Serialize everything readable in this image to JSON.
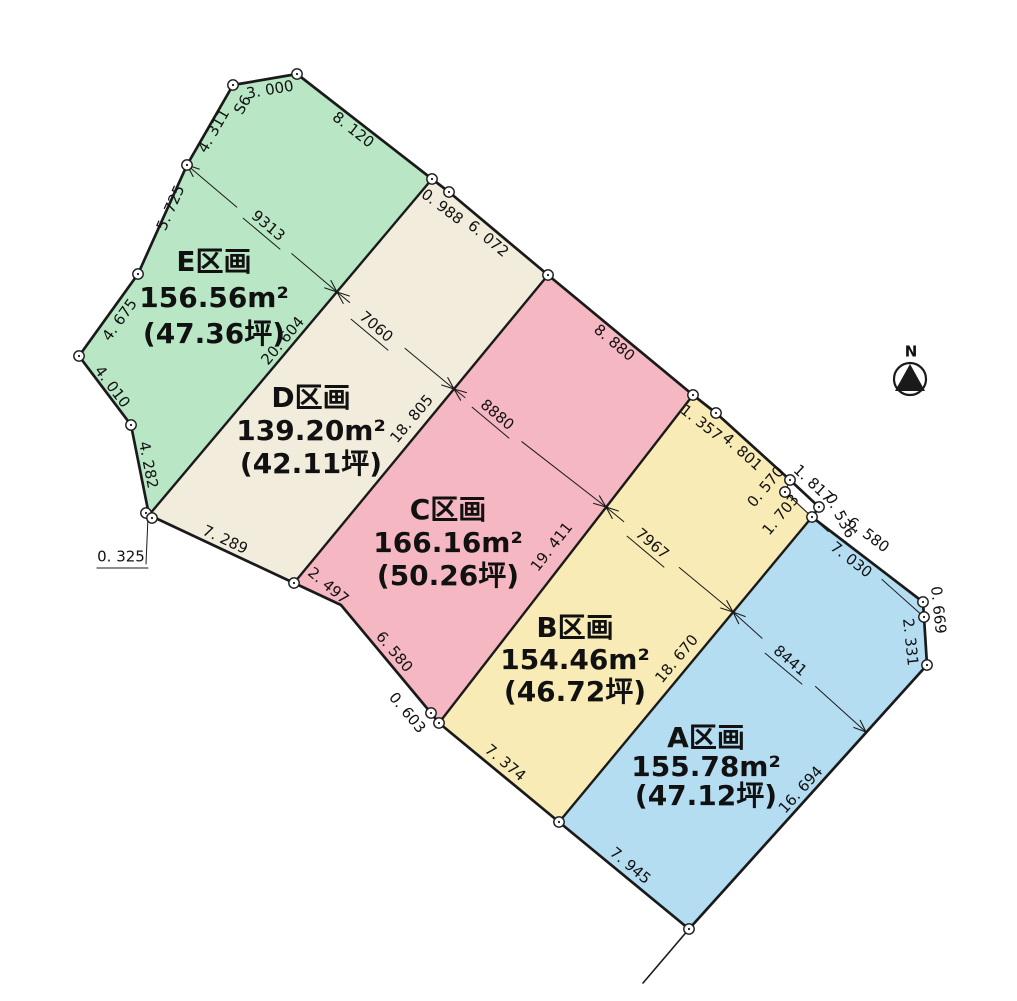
{
  "colors": {
    "line": "#1a1a1a",
    "plot_e": "#b9e6c5",
    "plot_d": "#f2ecdd",
    "plot_c": "#f5b7c1",
    "plot_b": "#f8ebb5",
    "plot_a": "#b4ddf2",
    "background": "#ffffff"
  },
  "plots": [
    {
      "id": "E",
      "name": "E区画",
      "area_m2": "156.56m²",
      "area_tsubo": "(47.36坪)",
      "color": "#b9e6c5",
      "points": [
        [
          297,
          74
        ],
        [
          432,
          179
        ],
        [
          149,
          515
        ],
        [
          131,
          425
        ],
        [
          79,
          356
        ],
        [
          138,
          274
        ],
        [
          187,
          165
        ],
        [
          233,
          85
        ]
      ],
      "label": {
        "x": 214,
        "y": 263,
        "lh": 36
      }
    },
    {
      "id": "D",
      "name": "D区画",
      "area_m2": "139.20m²",
      "area_tsubo": "(42.11坪)",
      "color": "#f2ecdd",
      "points": [
        [
          432,
          179
        ],
        [
          449,
          192
        ],
        [
          548,
          275
        ],
        [
          294,
          583
        ],
        [
          149,
          515
        ]
      ],
      "label": {
        "x": 311,
        "y": 399,
        "lh": 33
      }
    },
    {
      "id": "C",
      "name": "C区画",
      "area_m2": "166.16m²",
      "area_tsubo": "(50.26坪)",
      "color": "#f5b7c1",
      "points": [
        [
          548,
          275
        ],
        [
          693,
          395
        ],
        [
          439,
          723
        ],
        [
          431,
          713
        ],
        [
          341,
          605
        ],
        [
          294,
          583
        ]
      ],
      "label": {
        "x": 448,
        "y": 511,
        "lh": 33
      }
    },
    {
      "id": "B",
      "name": "B区画",
      "area_m2": "154.46m²",
      "area_tsubo": "(46.72坪)",
      "color": "#f8ebb5",
      "points": [
        [
          693,
          395
        ],
        [
          716,
          413
        ],
        [
          790,
          480
        ],
        [
          785,
          492
        ],
        [
          812,
          517
        ],
        [
          559,
          822
        ],
        [
          439,
          723
        ]
      ],
      "label": {
        "x": 575,
        "y": 629,
        "lh": 32
      }
    },
    {
      "id": "A",
      "name": "A区画",
      "area_m2": "155.78m²",
      "area_tsubo": "(47.12坪)",
      "color": "#b4ddf2",
      "points": [
        [
          812,
          517
        ],
        [
          923,
          602
        ],
        [
          924,
          617
        ],
        [
          927,
          665
        ],
        [
          689,
          929
        ],
        [
          559,
          822
        ]
      ],
      "label": {
        "x": 706,
        "y": 739,
        "lh": 29
      }
    }
  ],
  "setback_sliver": [
    [
      790,
      480
    ],
    [
      819,
      507
    ],
    [
      812,
      517
    ],
    [
      785,
      492
    ]
  ],
  "outline": [
    [
      297,
      74
    ],
    [
      432,
      179
    ],
    [
      449,
      192
    ],
    [
      548,
      275
    ],
    [
      693,
      395
    ],
    [
      716,
      413
    ],
    [
      790,
      480
    ],
    [
      819,
      507
    ],
    [
      812,
      517
    ],
    [
      923,
      602
    ],
    [
      924,
      617
    ],
    [
      927,
      665
    ],
    [
      689,
      929
    ],
    [
      559,
      822
    ],
    [
      439,
      723
    ],
    [
      431,
      713
    ],
    [
      341,
      605
    ],
    [
      294,
      583
    ],
    [
      149,
      515
    ],
    [
      131,
      425
    ],
    [
      79,
      356
    ],
    [
      138,
      274
    ],
    [
      187,
      165
    ],
    [
      233,
      85
    ]
  ],
  "internal_boundaries": [
    {
      "name": "boundary-e-d",
      "from": [
        432,
        179
      ],
      "to": [
        149,
        515
      ]
    },
    {
      "name": "boundary-d-c",
      "from": [
        548,
        275
      ],
      "to": [
        294,
        583
      ]
    },
    {
      "name": "boundary-c-b",
      "from": [
        693,
        395
      ],
      "to": [
        439,
        723
      ]
    },
    {
      "name": "boundary-b-a",
      "from": [
        812,
        517
      ],
      "to": [
        559,
        822
      ]
    }
  ],
  "thin_lines": [
    {
      "name": "b-corner-cut-1",
      "pts": [
        [
          790,
          480
        ],
        [
          785,
          492
        ]
      ],
      "w": 1.1
    },
    {
      "name": "b-corner-cut-2",
      "pts": [
        [
          785,
          492
        ],
        [
          812,
          517
        ]
      ],
      "w": 1.1
    },
    {
      "name": "boundary-tail",
      "pts": [
        [
          689,
          929
        ],
        [
          643,
          983
        ]
      ],
      "w": 1.6
    }
  ],
  "edge_labels": [
    {
      "text": "3. 000",
      "x": 270,
      "y": 90,
      "rot": -10
    },
    {
      "text": "S6",
      "x": 243,
      "y": 105,
      "rot": -60
    },
    {
      "text": "4. 311",
      "x": 214,
      "y": 131,
      "rot": -60
    },
    {
      "text": "8. 120",
      "x": 353,
      "y": 130,
      "rot": 38
    },
    {
      "text": "0. 988",
      "x": 442,
      "y": 207,
      "rot": 37
    },
    {
      "text": "6. 072",
      "x": 488,
      "y": 239,
      "rot": 40
    },
    {
      "text": "8. 880",
      "x": 614,
      "y": 343,
      "rot": 40
    },
    {
      "text": "1. 357",
      "x": 701,
      "y": 423,
      "rot": 38
    },
    {
      "text": "4. 801",
      "x": 742,
      "y": 452,
      "rot": 42
    },
    {
      "text": "0. 570",
      "x": 766,
      "y": 487,
      "rot": -50
    },
    {
      "text": "1. 703",
      "x": 781,
      "y": 515,
      "rot": -50
    },
    {
      "text": "1. 817",
      "x": 813,
      "y": 484,
      "rot": 43
    },
    {
      "text": "0. 536",
      "x": 840,
      "y": 516,
      "rot": 62
    },
    {
      "text": "6. 580",
      "x": 868,
      "y": 535,
      "rot": 37
    },
    {
      "text": "0. 669",
      "x": 938,
      "y": 610,
      "rot": 84
    },
    {
      "text": "2. 331",
      "x": 910,
      "y": 642,
      "rot": 84
    },
    {
      "text": "16. 694",
      "x": 801,
      "y": 790,
      "rot": -48
    },
    {
      "text": "7. 945",
      "x": 630,
      "y": 866,
      "rot": 40
    },
    {
      "text": "7. 374",
      "x": 505,
      "y": 763,
      "rot": 40
    },
    {
      "text": "0. 603",
      "x": 407,
      "y": 713,
      "rot": 50
    },
    {
      "text": "6. 580",
      "x": 394,
      "y": 652,
      "rot": 50
    },
    {
      "text": "2. 497",
      "x": 328,
      "y": 586,
      "rot": 40
    },
    {
      "text": "7. 289",
      "x": 225,
      "y": 540,
      "rot": 25
    },
    {
      "text": "4. 282",
      "x": 148,
      "y": 465,
      "rot": 79
    },
    {
      "text": "4. 010",
      "x": 112,
      "y": 387,
      "rot": 53
    },
    {
      "text": "4. 675",
      "x": 120,
      "y": 320,
      "rot": -54
    },
    {
      "text": "5. 725",
      "x": 171,
      "y": 208,
      "rot": -66
    },
    {
      "text": "20. 604",
      "x": 283,
      "y": 341,
      "rot": -50
    },
    {
      "text": "18. 805",
      "x": 412,
      "y": 419,
      "rot": -50
    },
    {
      "text": "19. 411",
      "x": 552,
      "y": 547,
      "rot": -52
    },
    {
      "text": "18. 670",
      "x": 677,
      "y": 659,
      "rot": -50
    }
  ],
  "dim_chains": [
    {
      "label": "9313",
      "from": [
        187,
        165
      ],
      "to": [
        337,
        292
      ],
      "lx": 268,
      "ly": 226,
      "rot": 40,
      "underline": true,
      "arrows": true
    },
    {
      "label": "7060",
      "from": [
        337,
        292
      ],
      "to": [
        454,
        389
      ],
      "lx": 376,
      "ly": 327,
      "rot": 40,
      "underline": true,
      "arrows": true
    },
    {
      "label": "8880",
      "from": [
        454,
        389
      ],
      "to": [
        606,
        507
      ],
      "lx": 497,
      "ly": 415,
      "rot": 40,
      "underline": true,
      "arrows": true
    },
    {
      "label": "7967",
      "from": [
        606,
        507
      ],
      "to": [
        733,
        612
      ],
      "lx": 652,
      "ly": 544,
      "rot": 40,
      "underline": true,
      "arrows": true
    },
    {
      "label": "8441",
      "from": [
        733,
        612
      ],
      "to": [
        866,
        732
      ],
      "lx": 790,
      "ly": 661,
      "rot": 40,
      "underline": true,
      "arrows": true
    },
    {
      "label": "7. 030",
      "from": [
        812,
        517
      ],
      "to": [
        924,
        617
      ],
      "lx": 851,
      "ly": 560,
      "rot": 38,
      "underline": false,
      "arrows": false
    }
  ],
  "leader_label": {
    "text": "0. 325",
    "x": 121,
    "y": 557,
    "leader": [
      [
        148,
        517
      ],
      [
        146,
        564
      ]
    ],
    "underline": [
      [
        97,
        568
      ],
      [
        148,
        568
      ]
    ]
  },
  "vertices": [
    [
      297,
      74
    ],
    [
      233,
      85
    ],
    [
      187,
      165
    ],
    [
      138,
      274
    ],
    [
      79,
      356
    ],
    [
      131,
      425
    ],
    [
      146,
      513
    ],
    [
      152,
      518
    ],
    [
      432,
      179
    ],
    [
      449,
      192
    ],
    [
      548,
      275
    ],
    [
      693,
      395
    ],
    [
      716,
      413
    ],
    [
      790,
      480
    ],
    [
      785,
      492
    ],
    [
      819,
      507
    ],
    [
      812,
      517
    ],
    [
      923,
      602
    ],
    [
      924,
      617
    ],
    [
      927,
      665
    ],
    [
      689,
      929
    ],
    [
      559,
      822
    ],
    [
      439,
      723
    ],
    [
      431,
      713
    ],
    [
      294,
      583
    ]
  ],
  "compass": {
    "letter": "N",
    "cx": 910,
    "cy": 379,
    "r": 16,
    "triangle": [
      [
        910,
        364
      ],
      [
        895,
        391
      ],
      [
        925,
        391
      ]
    ],
    "nx": 911,
    "ny": 361
  }
}
